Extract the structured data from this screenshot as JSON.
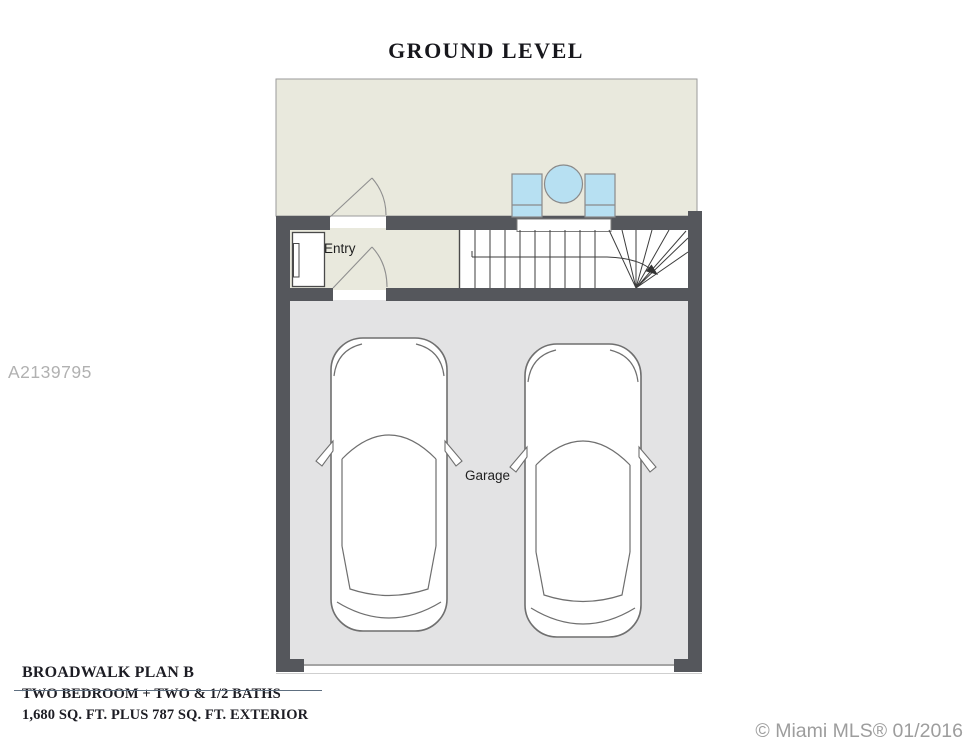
{
  "title": "GROUND LEVEL",
  "watermark": "A2139795",
  "plan": {
    "labels": {
      "entry": "Entry",
      "garage": "Garage"
    }
  },
  "footer": {
    "plan_name": "BROADWALK PLAN B",
    "line2": "TWO BEDROOM + TWO & 1/2 BATHS",
    "line3": "1,680 SQ. FT. PLUS 787 SQ. FT. EXTERIOR"
  },
  "copyright": "© Miami MLS® 01/2016",
  "colors": {
    "wall": "#55575c",
    "patio_floor": "#e9e9dd",
    "entry_floor": "#e9e9dd",
    "garage_floor": "#e3e3e4",
    "stairs_floor": "#ffffff",
    "furniture_blue": "#b7e0f2",
    "thin_outline": "#9a9a9a",
    "stair_line": "#3d3d3d",
    "car_outline": "#6f6f6f",
    "underline": "#5e6f80",
    "watermark_gray": "#b1b1b1",
    "copyright_gray": "#9d9d9d",
    "text_dark": "#1d1d24"
  }
}
